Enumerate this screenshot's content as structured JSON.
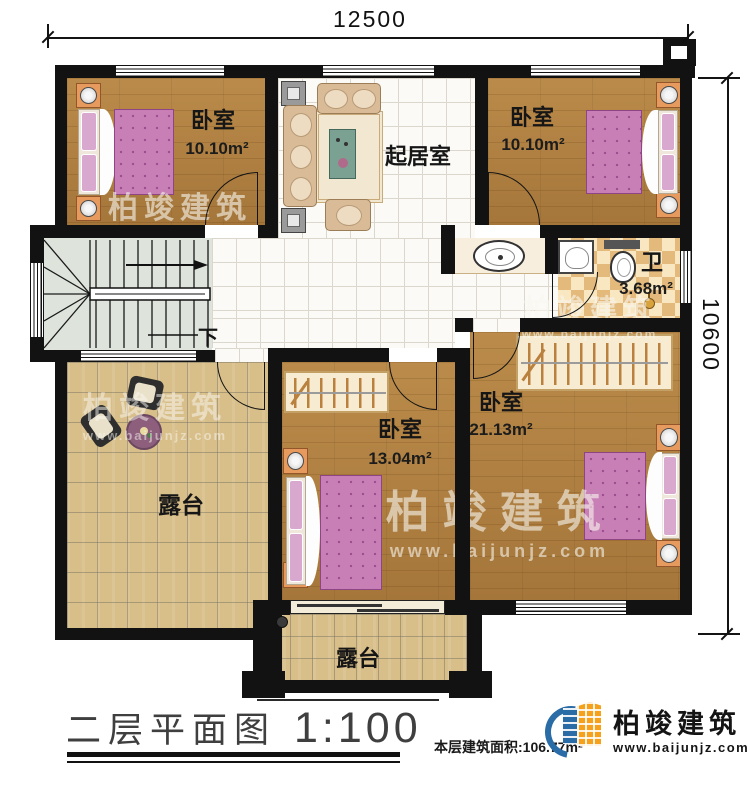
{
  "dimensions": {
    "top": "12500",
    "right": "10600"
  },
  "rooms": {
    "bedroom_top_left": {
      "name": "卧室",
      "area": "10.10m²"
    },
    "bedroom_top_right": {
      "name": "卧室",
      "area": "10.10m²"
    },
    "living_room": {
      "name": "起居室"
    },
    "bathroom": {
      "name": "卫",
      "area": "3.68m²"
    },
    "bedroom_right": {
      "name": "卧室",
      "area": "21.13m²"
    },
    "bedroom_center": {
      "name": "卧室",
      "area": "13.04m²"
    },
    "terrace_left": {
      "name": "露台"
    },
    "terrace_bottom": {
      "name": "露台"
    },
    "stairs": {
      "direction_label": "下"
    }
  },
  "title_block": {
    "plan_title": "二层平面图",
    "scale": "1:100",
    "area_label": "本层建筑面积:",
    "area_value": "106.77m²"
  },
  "branding": {
    "company": "柏竣建筑",
    "website": "www.baijunjz.com"
  },
  "colors": {
    "wall": "#121212",
    "wood_floor": "#b1813f",
    "terrace_floor": "#d8be89",
    "bathroom_tile": "#e3b97c",
    "bed": "#c77fb5",
    "logo_blue": "#2a6ca6",
    "logo_orange": "#f5a11b"
  }
}
